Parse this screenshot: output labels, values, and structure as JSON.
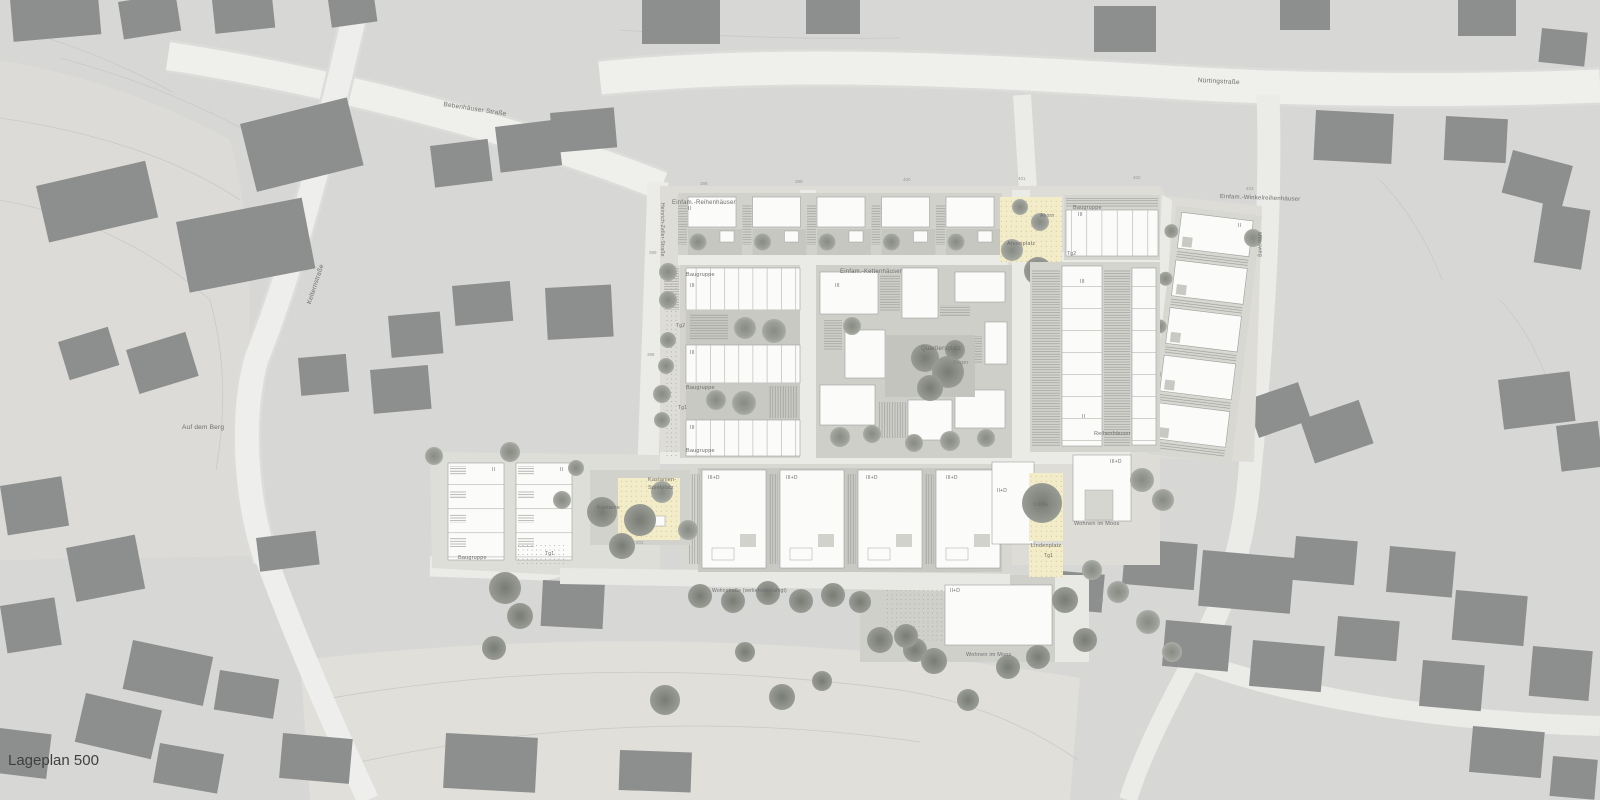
{
  "title": "Lageplan 500",
  "labels": {
    "lageplan": "Lageplan 500",
    "bebenhaeuser_strasse": "Bebenhäuser Straße",
    "nuertingstrasse": "Nürtingstraße",
    "kelternstrasse": "Kelternstraße",
    "heinrich_zeller_strasse": "Heinrich-Zeller-Straße",
    "moosweg": "Moosweg",
    "auf_dem_berg": "Auf dem Berg",
    "wohnstrasse": "Wohnstraße (verkehrsberuhigt)",
    "einfam_reihenhaeuser": "Einfam.-Reihenhäuser",
    "einfam_kettenhaeuser": "Einfam.-Kettenhäuser",
    "einfam_winkelreihenhaeuser": "Einfam.-Winkelreihenhäuser",
    "reihenhaeuser": "Reihenhäuser",
    "quartiersplatz": "Quartiersplatz",
    "anger": "Anger",
    "ahornplatz": "Ahornplatz",
    "lindenplatz": "Lindenplatz",
    "kastanien_line1": "Kastanien-",
    "kastanien_line2": "Spielplatz",
    "kastanie": "Kastanie",
    "linde": "Linde",
    "ahorn": "Ahorn",
    "wohnen_im_moos": "Wohnen im Moos",
    "baugruppe": "Baugruppe",
    "tg1": "Tg1",
    "tg2": "Tg2",
    "floor_ii": "II",
    "floor_iii": "III",
    "floor_ii_d": "II+D",
    "floor_iii_d": "III+D"
  },
  "elev": {
    "e398": "398",
    "e399": "399",
    "e400": "400",
    "e401": "401",
    "e402": "402",
    "e403": "403"
  },
  "colors": {
    "background": "#d7d7d5",
    "existing_building": "#8d8f8f",
    "new_building": "#fbfbfa",
    "plaza_yellow": "#f3ecc8",
    "street": "#efefec",
    "tree": "#9b9d97"
  }
}
